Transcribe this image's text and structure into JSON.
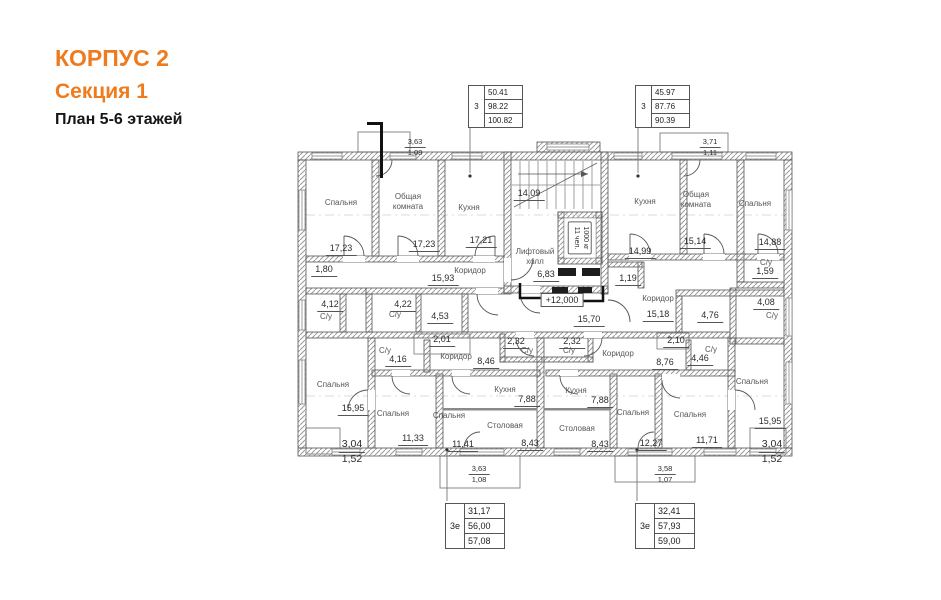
{
  "header": {
    "building": "КОРПУС 2",
    "section": "Секция 1",
    "plan": "План 5-6 этажей"
  },
  "palette": {
    "accent": "#ee7b1d",
    "wall_line": "#555555",
    "hatch": "#9a9a9a",
    "room_text": "#555555",
    "dim_text": "#2b2b2b"
  },
  "tables": {
    "top_left": {
      "type": "3",
      "rows": [
        "50.41",
        "98.22",
        "100.82"
      ]
    },
    "top_right": {
      "type": "3",
      "rows": [
        "45.97",
        "87.76",
        "90.39"
      ]
    },
    "bottom_left": {
      "type": "3е",
      "rows": [
        "31,17",
        "56,00",
        "57,08"
      ]
    },
    "bottom_right": {
      "type": "3е",
      "rows": [
        "32,41",
        "57,93",
        "59,00"
      ]
    }
  },
  "level_mark": "+12,000",
  "elevator": {
    "capacity": "1000 кг",
    "persons": "11 чел."
  },
  "rooms": {
    "spalnya_tl": {
      "name": "Спальня",
      "area": "17,23"
    },
    "obshaya_tl": {
      "name": "Общая комната",
      "area": "17,23"
    },
    "kuhnya_tl": {
      "name": "Кухня",
      "area": "17,21"
    },
    "koridor_tl": {
      "name": "Коридор",
      "area": "15,93"
    },
    "su_180": {
      "area": "1,80"
    },
    "su_412": {
      "name": "С/у",
      "area": "4,12"
    },
    "su_422": {
      "name": "С/у",
      "area": "4,22"
    },
    "r_453": {
      "area": "4,53"
    },
    "stair": {
      "area": "14,09"
    },
    "lift_hall": {
      "name": "Лифтовый холл",
      "area": "6,83"
    },
    "corr_1570": {
      "area": "15,70"
    },
    "kuhnya_tr": {
      "name": "Кухня",
      "area": "14,99"
    },
    "obshaya_tr": {
      "name": "Общая комната",
      "area": "15,14"
    },
    "spalnya_tr": {
      "name": "Спальня",
      "area": "14,88"
    },
    "su_159": {
      "name": "С/у",
      "area": "1,59"
    },
    "r_119": {
      "area": "1,19"
    },
    "korid_1518": {
      "name": "Коридор",
      "area": "15,18"
    },
    "r_476": {
      "area": "4,76"
    },
    "su_408": {
      "name": "С/у",
      "area": "4,08"
    },
    "r_201": {
      "area": "2,01"
    },
    "su_416": {
      "name": "С/у",
      "area": "4,16"
    },
    "korid_846": {
      "name": "Коридор",
      "area": "8,46"
    },
    "su_232_l": {
      "name": "С/у",
      "area": "2,32"
    },
    "su_232_r": {
      "name": "С/у",
      "area": "2,32"
    },
    "korid_876": {
      "name": "Коридор",
      "area": "8,76"
    },
    "r_210": {
      "area": "2,10"
    },
    "su_446": {
      "name": "С/у",
      "area": "4,46"
    },
    "spalnya_bl1": {
      "name": "Спальня",
      "area": "15,95"
    },
    "spalnya_bl2": {
      "name": "Спальня",
      "area": "11,33"
    },
    "spalnya_bl3": {
      "name": "Спальня",
      "area": "11,41"
    },
    "kuhnya_bl": {
      "name": "Кухня",
      "area": "7,88"
    },
    "stolov_bl": {
      "name": "Столовая",
      "area": "8,43"
    },
    "kuhnya_br": {
      "name": "Кухня",
      "area": "7,88"
    },
    "stolov_br": {
      "name": "Столовая",
      "area": "8,43"
    },
    "spalnya_br1": {
      "name": "Спальня",
      "area": "12,27"
    },
    "spalnya_br2": {
      "name": "Спальня",
      "area": "11,71"
    },
    "spalnya_br3": {
      "name": "Спальня",
      "area": "15,95"
    }
  },
  "balconies": {
    "top_left": {
      "a": "3,63",
      "b": "1,08"
    },
    "top_right": {
      "a": "3,71",
      "b": "1,11"
    },
    "bottom_left_corner": {
      "a": "3,04",
      "b": "1,52"
    },
    "bottom_center_left": {
      "a": "3,63",
      "b": "1,08"
    },
    "bottom_center_right": {
      "a": "3,58",
      "b": "1,07"
    },
    "bottom_right_corner": {
      "a": "3,04",
      "b": "1,52"
    }
  }
}
